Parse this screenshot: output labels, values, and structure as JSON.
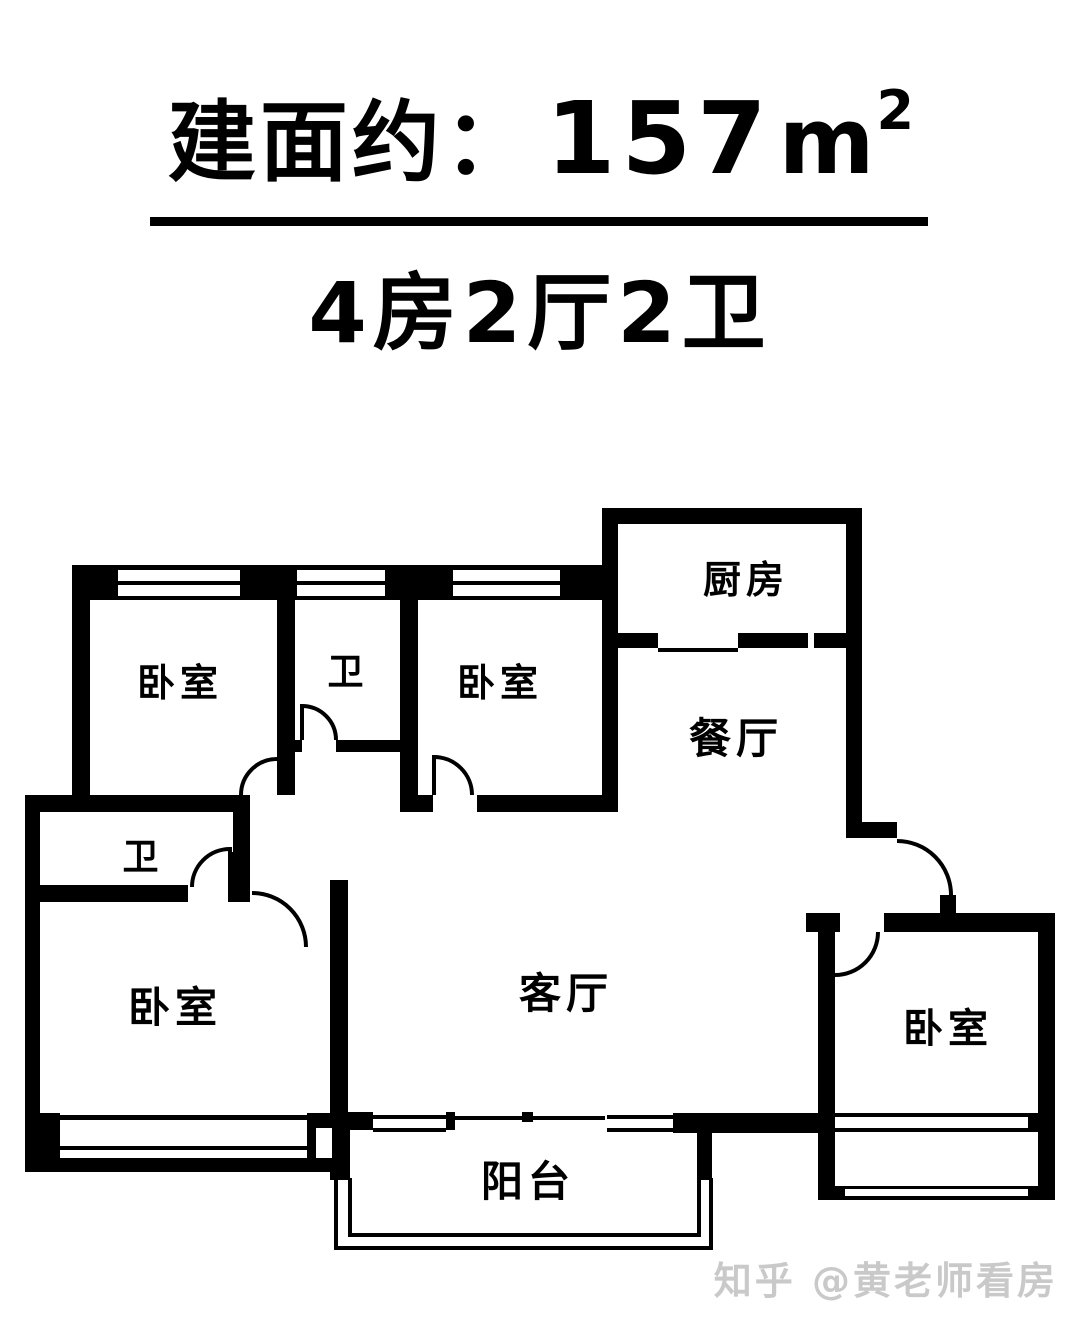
{
  "header": {
    "area_prefix": "建面约：",
    "area_value": "157",
    "area_unit_base": "m",
    "area_unit_exp": "2",
    "layout_text": "4房2厅2卫"
  },
  "floor_plan": {
    "rooms": {
      "bedroom_top_left": "卧室",
      "bath_top": "卫",
      "bedroom_top_right": "卧室",
      "kitchen": "厨房",
      "dining_room": "餐厅",
      "bath_left": "卫",
      "bedroom_bottom_left": "卧室",
      "living_room": "客厅",
      "balcony": "阳台",
      "bedroom_bottom_right": "卧室"
    }
  },
  "watermark": "知乎 @黄老师看房",
  "colors": {
    "ink": "#000000",
    "background": "#ffffff",
    "watermark_gray": "#c9c9c9"
  }
}
